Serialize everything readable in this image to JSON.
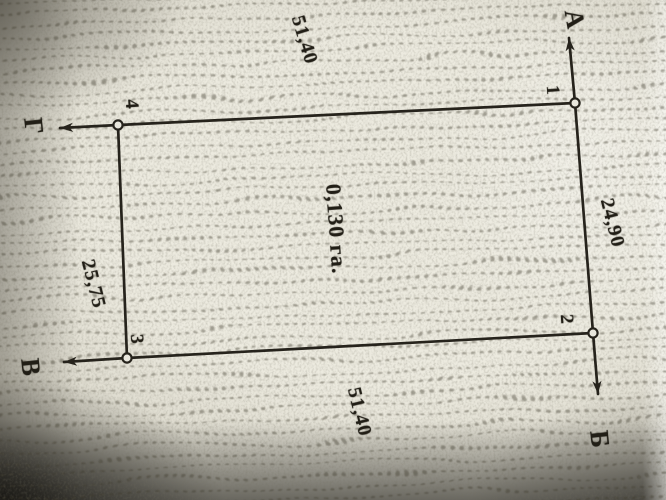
{
  "photo": {
    "colors": {
      "paper": "#e9e7dd",
      "ink": "#26231c"
    }
  },
  "plot": {
    "area_label": "0,130 га.",
    "points": [
      {
        "label": "1"
      },
      {
        "label": "2"
      },
      {
        "label": "3"
      },
      {
        "label": "4"
      }
    ],
    "sides": [
      {
        "position": "top",
        "label": "51,40"
      },
      {
        "position": "right",
        "label": "24,90"
      },
      {
        "position": "bottom",
        "label": "51,40"
      },
      {
        "position": "left",
        "label": "25,75"
      }
    ],
    "directions": [
      {
        "position": "top",
        "label": "А"
      },
      {
        "position": "bottom-right",
        "label": "Б"
      },
      {
        "position": "bottom-left",
        "label": "В"
      },
      {
        "position": "left",
        "label": "Г"
      }
    ]
  }
}
